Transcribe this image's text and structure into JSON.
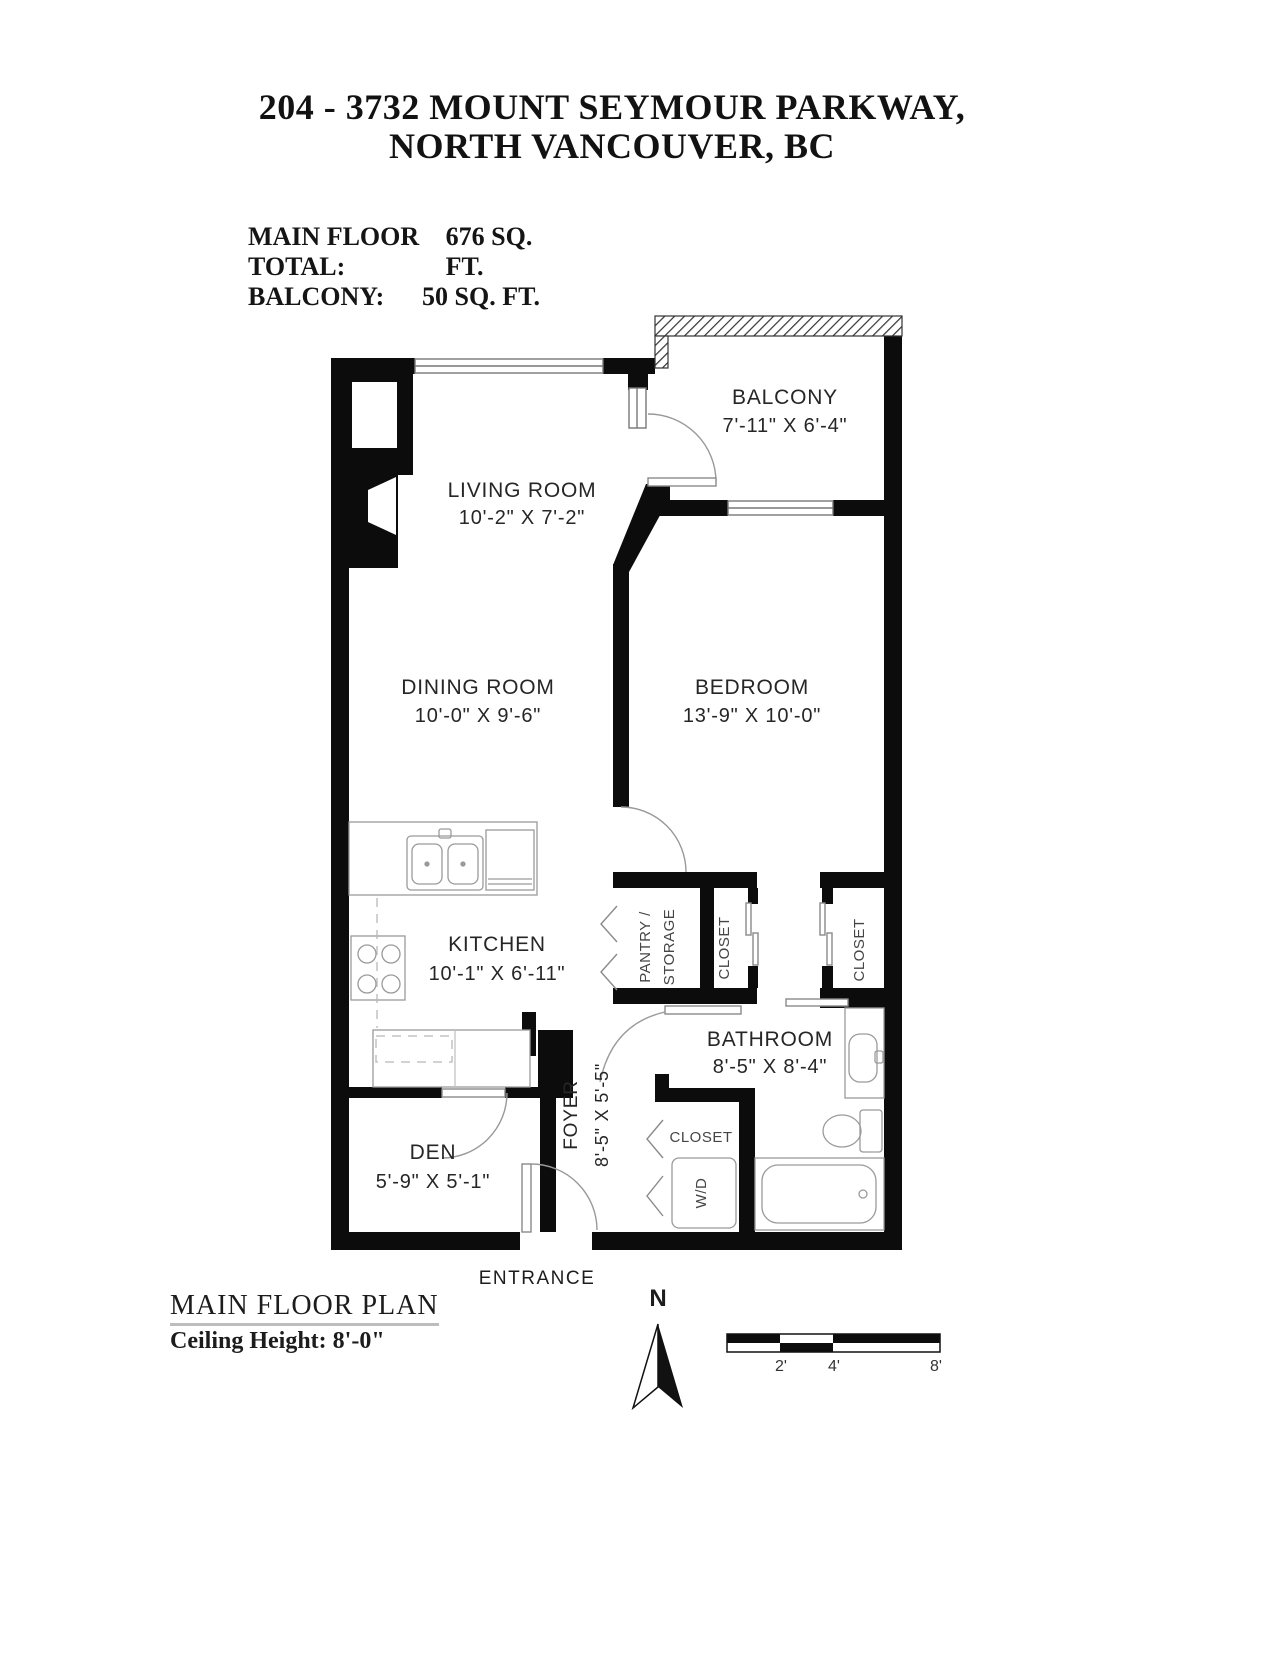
{
  "title": {
    "line1": "204 - 3732 MOUNT SEYMOUR PARKWAY,",
    "line2": "NORTH VANCOUVER, BC"
  },
  "areas": {
    "rows": [
      {
        "label": "MAIN FLOOR TOTAL:",
        "value": "676 SQ. FT."
      },
      {
        "label": "BALCONY:",
        "value": "50 SQ. FT."
      }
    ]
  },
  "rooms": {
    "balcony": {
      "name": "BALCONY",
      "dims": "7'-11\" X 6'-4\""
    },
    "living_room": {
      "name": "LIVING ROOM",
      "dims": "10'-2\" X 7'-2\""
    },
    "dining_room": {
      "name": "DINING ROOM",
      "dims": "10'-0\" X 9'-6\""
    },
    "bedroom": {
      "name": "BEDROOM",
      "dims": "13'-9\" X 10'-0\""
    },
    "kitchen": {
      "name": "KITCHEN",
      "dims": "10'-1\" X 6'-11\""
    },
    "bathroom": {
      "name": "BATHROOM",
      "dims": "8'-5\" X 8'-4\""
    },
    "den": {
      "name": "DEN",
      "dims": "5'-9\" X 5'-1\""
    },
    "foyer": {
      "name": "FOYER",
      "dims": "8'-5\" X 5'-5\""
    }
  },
  "features": {
    "pantry_line1": "PANTRY /",
    "pantry_line2": "STORAGE",
    "closet_bedroom_left": "CLOSET",
    "closet_bedroom_right": "CLOSET",
    "closet_foyer": "CLOSET",
    "washer_dryer": "W/D",
    "entrance": "ENTRANCE"
  },
  "footer": {
    "plan_title": "MAIN FLOOR PLAN",
    "ceiling_height": "Ceiling Height: 8'-0\"",
    "north_label": "N"
  },
  "scale_bar": {
    "tick_labels": [
      "2'",
      "4'",
      "8'"
    ]
  },
  "colors": {
    "wall": "#0c0c0c",
    "fixture_line": "#9a9a9a",
    "text": "#262626"
  }
}
